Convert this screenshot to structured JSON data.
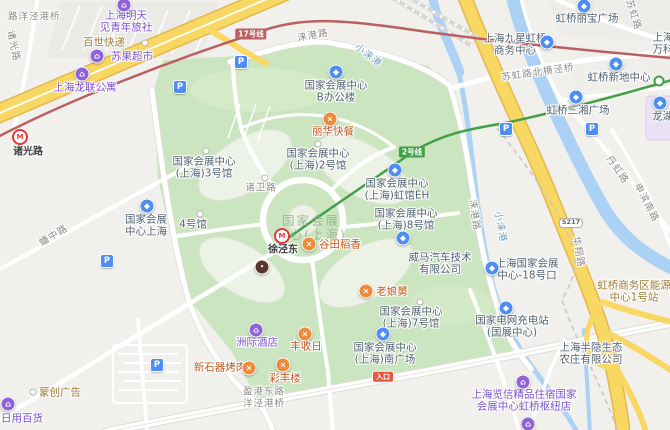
{
  "meta": {
    "description": "web map of National Exhibition and Convention Center (Shanghai) area, Hongqiao"
  },
  "palette": {
    "park_green": "#cbe5c0",
    "water_blue": "#abd2f4",
    "highway_yellow": "#f8d763",
    "road_white": "#ffffff",
    "metro_line2_green": "#43a047",
    "metro_line17_red": "#ba6060",
    "restaurant_orange": "#ee8a3a",
    "lodging_purple": "#8f63d6",
    "generic_blue": "#4d8ef0",
    "parking_blue": "#4e8df5",
    "label_blue_grey": "#51616f",
    "label_restaurant": "#c2591f",
    "label_purple": "#7d52cc",
    "label_road_grey": "#8d8b87",
    "label_water": "#6f9bbf",
    "entrance_red": "#e8553d",
    "metro_logo_red": "#e23a3c"
  },
  "icons": {
    "restaurant_glyph": "×",
    "lodging_glyph": "⌂",
    "generic_glyph": "◆",
    "parking_glyph": "P",
    "metro_glyph": "M",
    "dark_glyph": "•"
  },
  "badges": {
    "line17": "17号线",
    "line2": "2号线",
    "road_shield": "S217",
    "entrance": "入口"
  },
  "stations": {
    "zhuguanglu": "诸光路",
    "xujingdong": "徐泾东"
  },
  "watermark": {
    "l1": "国家会展",
    "l2": "中心(上海)"
  },
  "roads": {
    "yangjinggang_bridge": "路洋泾港桥",
    "zhuguang": "诸光路",
    "laigang_n": "涞港路",
    "laigang_e": "涞港路",
    "xiaolaigang_n": "小涞港",
    "xiaolaigang_s": "小涞港",
    "suhong_bridge": "苏虹路北横泾桥",
    "suhong": "苏虹路",
    "danhong": "丹虹路",
    "shenbin_s": "申滨南路",
    "huaxiang": "华翔路",
    "panzhong": "蟠中路",
    "zhuwei": "诸卫路",
    "yinggang_l1": "盈港东路",
    "yinggang_l2": "洋泾港桥"
  },
  "pois": {
    "hostel": {
      "l1": "上海明天",
      "l2": "见青年旅社"
    },
    "baishi": {
      "label": "百世快递"
    },
    "suguo": {
      "label": "苏果超市"
    },
    "longlian": {
      "label": "上海龙联公寓"
    },
    "lihua": {
      "label": "丽华快餐"
    },
    "necc_b_office": {
      "l1": "国家会展中心",
      "l2": "B办公楼"
    },
    "necc_shanghai": {
      "l1": "国家会展",
      "l2": "中心上海"
    },
    "hall2": {
      "l1": "国家会展中心",
      "l2": "(上海)2号馆"
    },
    "hall3": {
      "l1": "国家会展中心",
      "l2": "(上海)3号馆"
    },
    "hall4": {
      "label": "4号馆"
    },
    "hall_eh": {
      "l1": "国家会展中心",
      "l2": "(上海)虹馆EH"
    },
    "hall8": {
      "l1": "国家会展中心",
      "l2": "(上海)8号馆"
    },
    "hall7": {
      "l1": "国家会展中心",
      "l2": "(上海)7号馆"
    },
    "south_plaza": {
      "l1": "国家会展中心",
      "l2": "(上海)南广场"
    },
    "gate18": {
      "l1": "上海国家会展",
      "l2": "中心-18号口"
    },
    "weltmeister": {
      "l1": "威马汽车技术",
      "l2": "有限公司"
    },
    "gutian": {
      "label": "谷田稻香"
    },
    "laoniangjiu": {
      "label": "老娘舅"
    },
    "fengshouri": {
      "label": "丰收日"
    },
    "caifenglou": {
      "label": "彩丰楼"
    },
    "xinshiqi": {
      "label": "新石器烤肉"
    },
    "intercontinental": {
      "label": "洲际酒店"
    },
    "lanxin": {
      "l1": "上海览信精品住宿国家",
      "l2": "会展中心虹桥枢纽店"
    },
    "state_grid": {
      "l1": "国家电网充电站",
      "l2": "(国展中心)"
    },
    "banyin": {
      "l1": "上海半隐生态",
      "l2": "农庄有限公司"
    },
    "energy_station": {
      "l1": "虹桥商务区能源",
      "l2": "中心1号站"
    },
    "mengchuang": {
      "label": "蒙创广告"
    },
    "riyongbaihuo": {
      "label": "日用百货"
    },
    "libao": {
      "label": "虹桥丽宝广场"
    },
    "jiuxing": {
      "l1": "上海九星虹桥",
      "l2": "商务中心"
    },
    "xindi": {
      "label": "虹桥新地中心"
    },
    "sanxiang": {
      "label": "虹桥三湘广场"
    },
    "edge_ne": {
      "l1": "上海",
      "l2": "万科"
    },
    "longhu": {
      "label": "龙湖天街"
    }
  }
}
